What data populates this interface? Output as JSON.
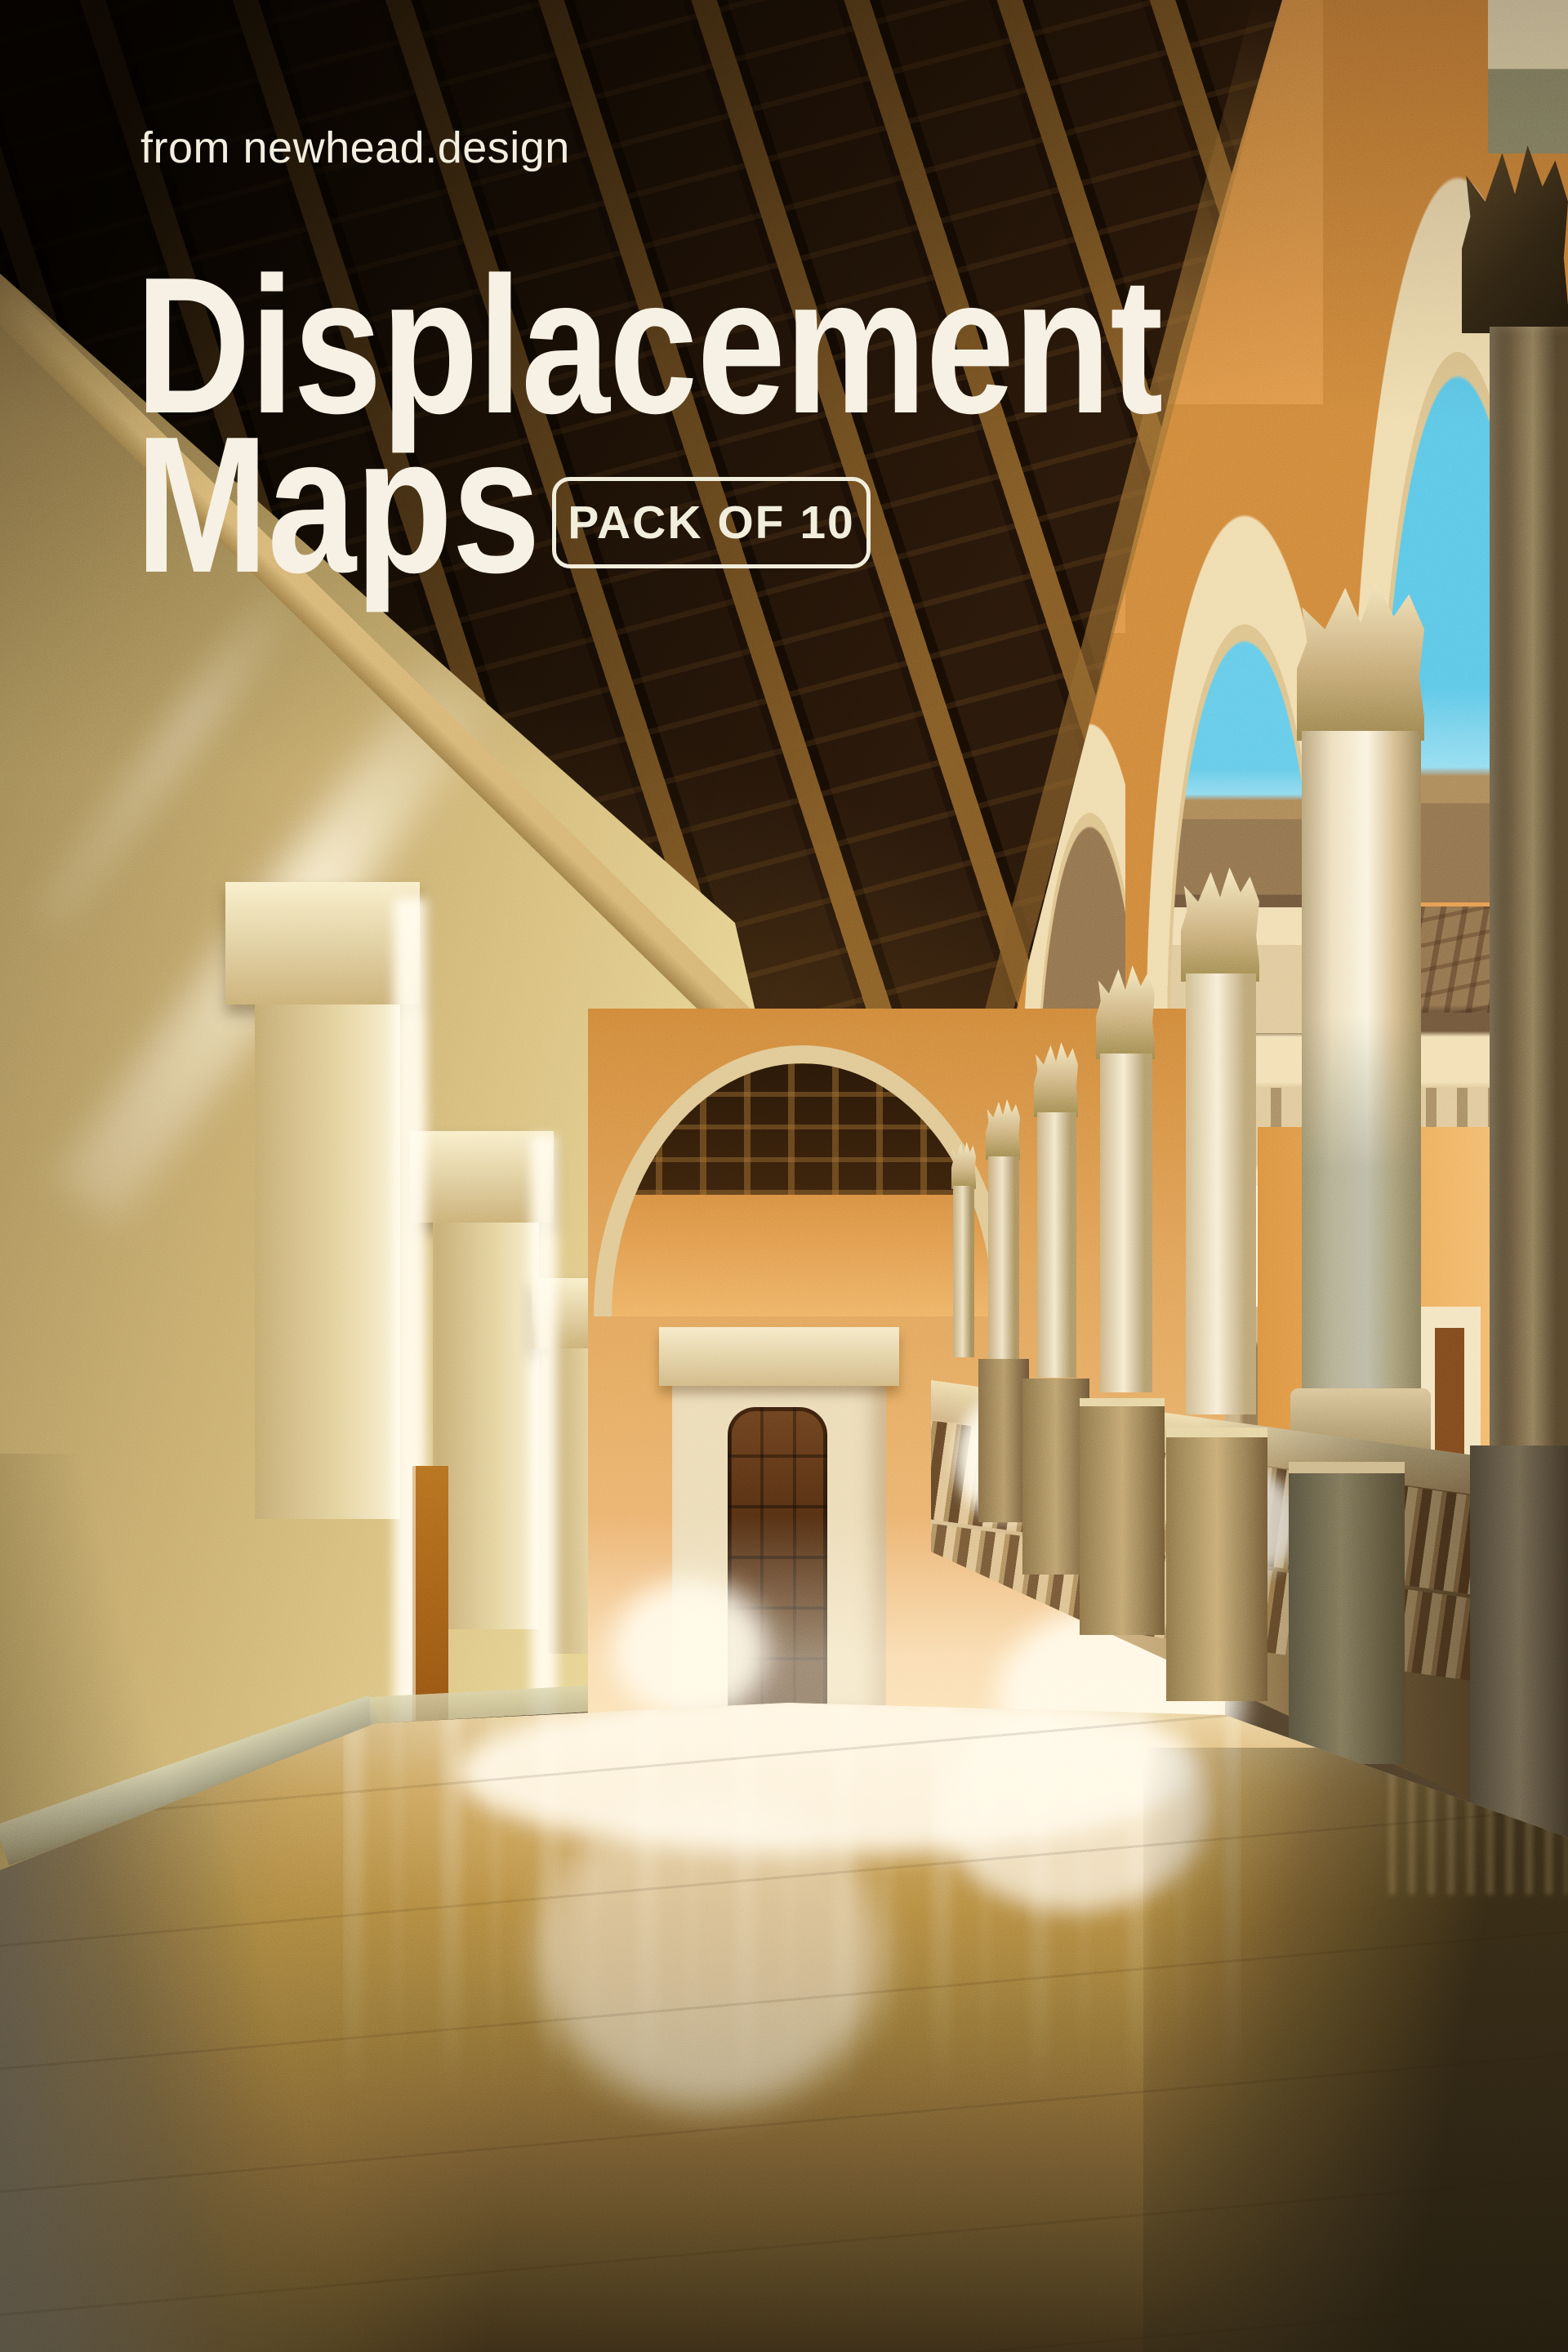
{
  "poster": {
    "brand": "from newhead.design",
    "title_line1": "Displacement",
    "title_line2": "Maps",
    "badge_label": "PACK OF 10",
    "text_color": "#f6f1e4"
  },
  "palette": {
    "sky": "#5fc2e0",
    "ceiling_wood_dark": "#241608",
    "ceiling_wood_beam": "#8a5f2c",
    "arcade_orange": "#cf8a44",
    "left_wall_tan": "#c9b077",
    "stone_cream": "#efe3c0",
    "floor_amber": "#b98f49",
    "floor_shadow": "#3f321c",
    "sunlight": "#fff7e0"
  }
}
